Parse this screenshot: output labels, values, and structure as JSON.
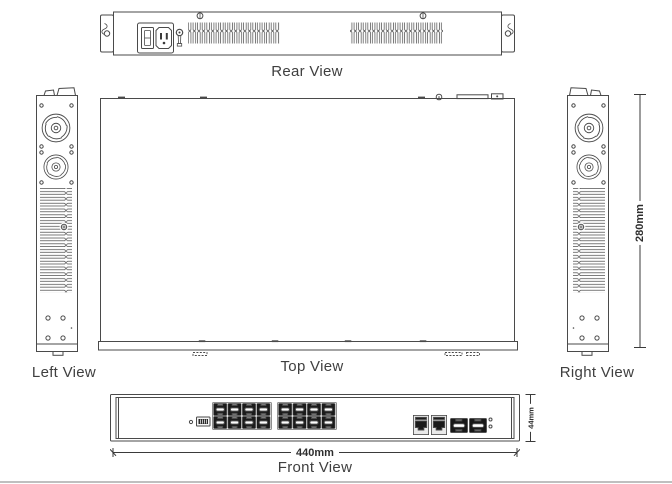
{
  "views": {
    "rear": {
      "label": "Rear View"
    },
    "left": {
      "label": "Left View"
    },
    "top": {
      "label": "Top View"
    },
    "right": {
      "label": "Right View"
    },
    "front": {
      "label": "Front View"
    }
  },
  "dimensions": {
    "front_width": "440mm",
    "side_height": "280mm",
    "front_height": "44mm"
  },
  "device": {
    "sfp_cage_ports": 16,
    "rj45_ports": 2,
    "sfp_uplink_ports": 2,
    "fans_per_side": 2,
    "status_leds": 2,
    "rear_vent_groups": 2
  },
  "colors": {
    "line": "#4a4a4a",
    "text": "#3f3f3f",
    "port_dark": "#1b1b1b",
    "port_frame": "#8f8f8f",
    "page_rule": "#bfbfbf"
  }
}
